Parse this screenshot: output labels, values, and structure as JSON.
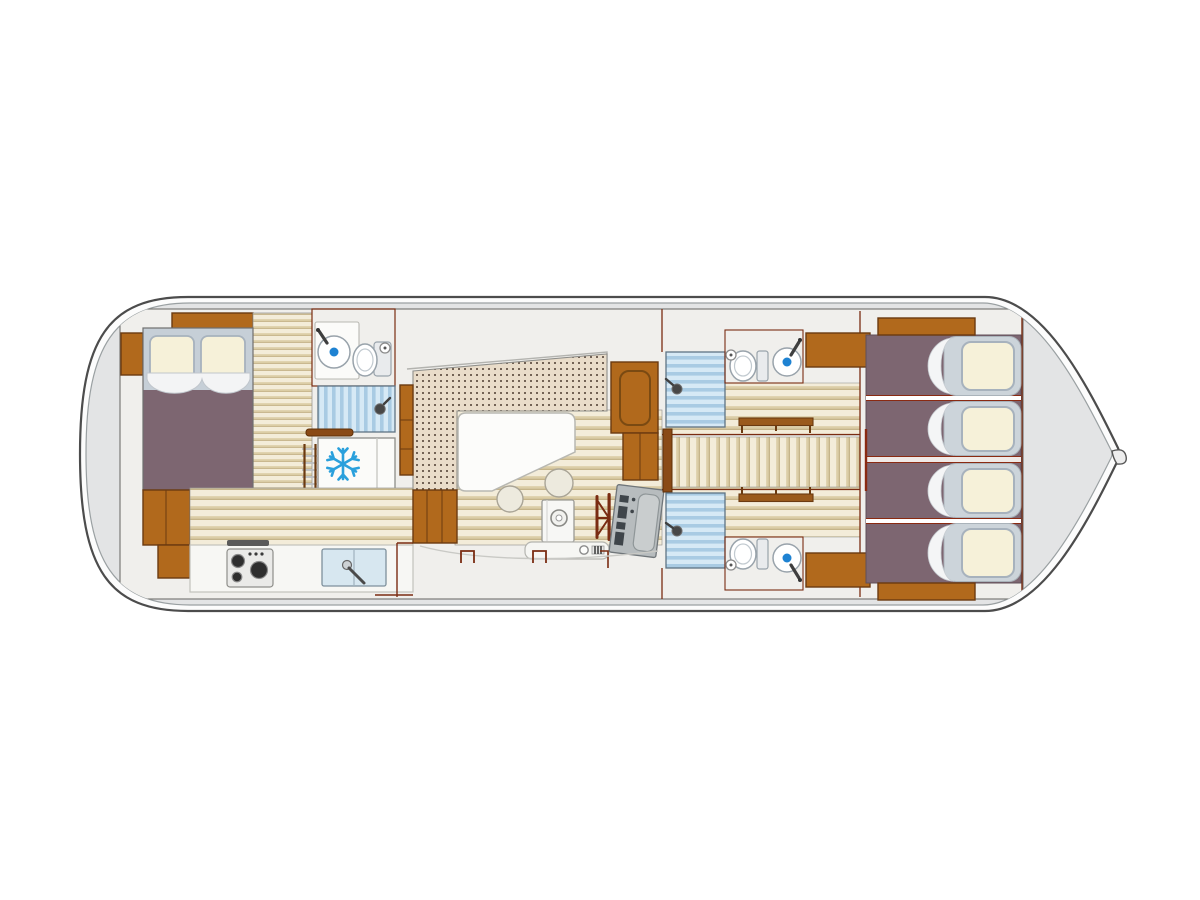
{
  "page": {
    "background": "#ffffff",
    "content": "houseboat-floor-plan"
  },
  "palette": {
    "hull_outline": "#4c4c4c",
    "deck_gray": "#e3e4e5",
    "interior": "#f0efec",
    "wall_line": "#7a2c12",
    "wood": "#b1691c",
    "wood_dark": "#8a4a16",
    "floor_cream": "#f3ecd9",
    "floor_beige": "#dbcda6",
    "bed_purple": "#7d6671",
    "pillow_cream": "#f6f1d9",
    "pillow_gray": "#ccd4da",
    "headboard_gray": "#c6cfd7",
    "upholstery_dot_bg": "#e9dcc9",
    "upholstery_dot": "#57463a",
    "shower_blue_light": "#d6e9f5",
    "shower_blue": "#a9cbe3",
    "accent_blue": "#1e82d2",
    "snowflake_blue": "#2aa0dc",
    "console_gray": "#b7bcbe"
  },
  "boat": {
    "type": "canal-houseboat",
    "view": "top-down-floor-plan",
    "bow": "right",
    "sections": [
      {
        "name": "stern-deck",
        "items": []
      },
      {
        "name": "master-cabin",
        "items": [
          "double-bed",
          "pillow",
          "pillow",
          "nightstand",
          "shelf",
          "wardrobe"
        ]
      },
      {
        "name": "forward-bathroom",
        "items": [
          "washbasin",
          "toilet",
          "shower"
        ]
      },
      {
        "name": "galley",
        "items": [
          "refrigerator",
          "grab-rail",
          "ladder",
          "stove-3-burner",
          "double-sink",
          "counter"
        ]
      },
      {
        "name": "saloon",
        "items": [
          "u-shaped-dinette",
          "dining-table",
          "stool",
          "stool",
          "helm-console",
          "steering-wheel",
          "instrument-panel",
          "wardrobe"
        ]
      },
      {
        "name": "side-deck",
        "items": [
          "deck-cleat",
          "deck-cleat"
        ]
      },
      {
        "name": "guest-cabin-port",
        "items": [
          "shower",
          "toilet",
          "washbasin",
          "bench",
          "cabinet"
        ]
      },
      {
        "name": "corridor",
        "items": []
      },
      {
        "name": "guest-cabin-starboard",
        "items": [
          "shower",
          "toilet",
          "washbasin",
          "bench",
          "cabinet"
        ]
      },
      {
        "name": "aft-cabins",
        "items": [
          "single-bed",
          "single-bed",
          "single-bed",
          "single-bed"
        ]
      },
      {
        "name": "bow-deck",
        "items": [
          "bow-cleat"
        ]
      }
    ]
  }
}
